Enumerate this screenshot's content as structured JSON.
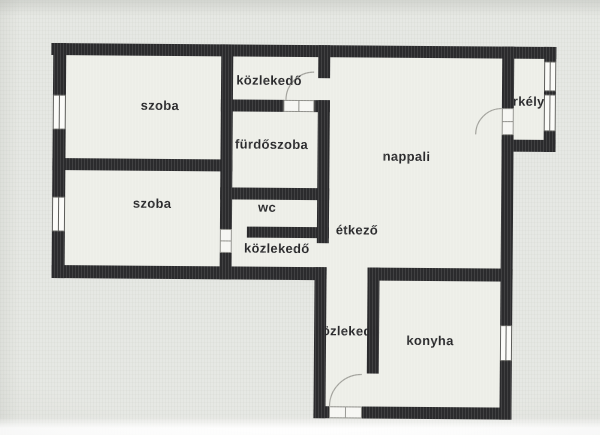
{
  "rooms": {
    "szoba1": {
      "label": "szoba"
    },
    "szoba2": {
      "label": "szoba"
    },
    "kozlekedo_top": {
      "label": "közlekedő"
    },
    "furdoszoba": {
      "label": "fürdőszoba"
    },
    "wc": {
      "label": "wc"
    },
    "kozlekedo_left": {
      "label": "közlekedő"
    },
    "etkezo": {
      "label": "étkező"
    },
    "nappali": {
      "label": "nappali"
    },
    "erkely": {
      "label": "erkély"
    },
    "kozlekedo_bottom": {
      "label": "közlekedő"
    },
    "konyha": {
      "label": "konyha"
    }
  },
  "colors": {
    "wall": "#2b2b2d",
    "floor": "#edeee8",
    "label_text": "#2a2a2c",
    "window_frame": "#5d5d5a",
    "door_frame": "#8f8f8a",
    "door_arc": "#a3a39d"
  }
}
